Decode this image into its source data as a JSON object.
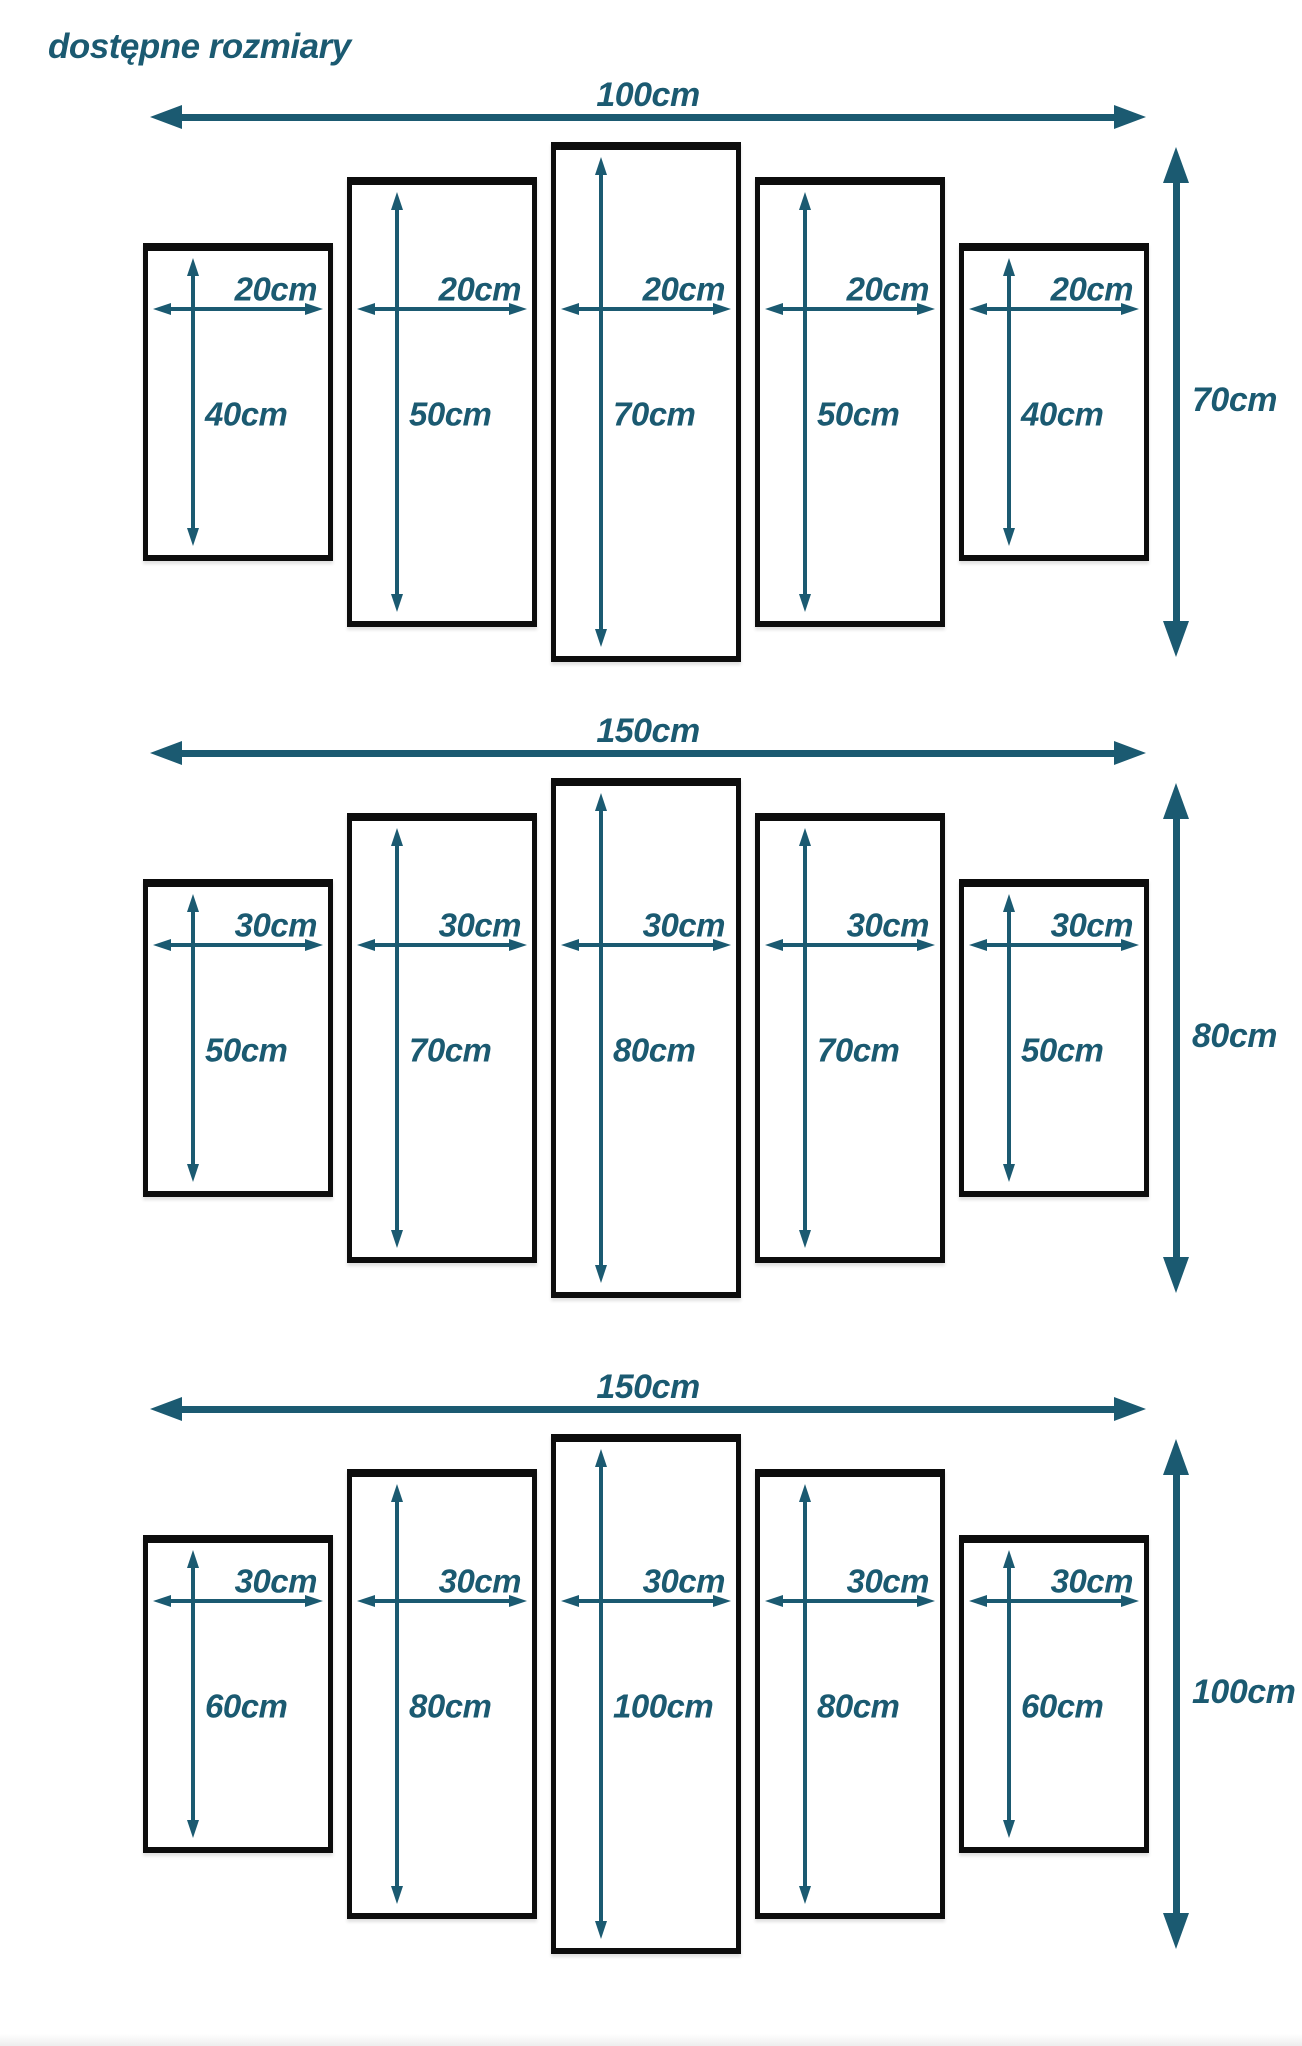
{
  "title": "dostępne rozmiary",
  "colors": {
    "accent": "#1b5a71",
    "panel_border": "#0d0d0d",
    "background": "#ffffff"
  },
  "groups": [
    {
      "total_width_label": "100cm",
      "total_height_label": "70cm",
      "total_width_cm": 100,
      "total_height_cm": 70,
      "panels": [
        {
          "width_label": "20cm",
          "height_label": "40cm",
          "width_cm": 20,
          "height_cm": 40
        },
        {
          "width_label": "20cm",
          "height_label": "50cm",
          "width_cm": 20,
          "height_cm": 50
        },
        {
          "width_label": "20cm",
          "height_label": "70cm",
          "width_cm": 20,
          "height_cm": 70
        },
        {
          "width_label": "20cm",
          "height_label": "50cm",
          "width_cm": 20,
          "height_cm": 50
        },
        {
          "width_label": "20cm",
          "height_label": "40cm",
          "width_cm": 20,
          "height_cm": 40
        }
      ]
    },
    {
      "total_width_label": "150cm",
      "total_height_label": "80cm",
      "total_width_cm": 150,
      "total_height_cm": 80,
      "panels": [
        {
          "width_label": "30cm",
          "height_label": "50cm",
          "width_cm": 30,
          "height_cm": 50
        },
        {
          "width_label": "30cm",
          "height_label": "70cm",
          "width_cm": 30,
          "height_cm": 70
        },
        {
          "width_label": "30cm",
          "height_label": "80cm",
          "width_cm": 30,
          "height_cm": 80
        },
        {
          "width_label": "30cm",
          "height_label": "70cm",
          "width_cm": 30,
          "height_cm": 70
        },
        {
          "width_label": "30cm",
          "height_label": "50cm",
          "width_cm": 30,
          "height_cm": 50
        }
      ]
    },
    {
      "total_width_label": "150cm",
      "total_height_label": "100cm",
      "total_width_cm": 150,
      "total_height_cm": 100,
      "panels": [
        {
          "width_label": "30cm",
          "height_label": "60cm",
          "width_cm": 30,
          "height_cm": 60
        },
        {
          "width_label": "30cm",
          "height_label": "80cm",
          "width_cm": 30,
          "height_cm": 80
        },
        {
          "width_label": "30cm",
          "height_label": "100cm",
          "width_cm": 30,
          "height_cm": 100
        },
        {
          "width_label": "30cm",
          "height_label": "80cm",
          "width_cm": 30,
          "height_cm": 80
        },
        {
          "width_label": "30cm",
          "height_label": "60cm",
          "width_cm": 30,
          "height_cm": 60
        }
      ]
    }
  ]
}
